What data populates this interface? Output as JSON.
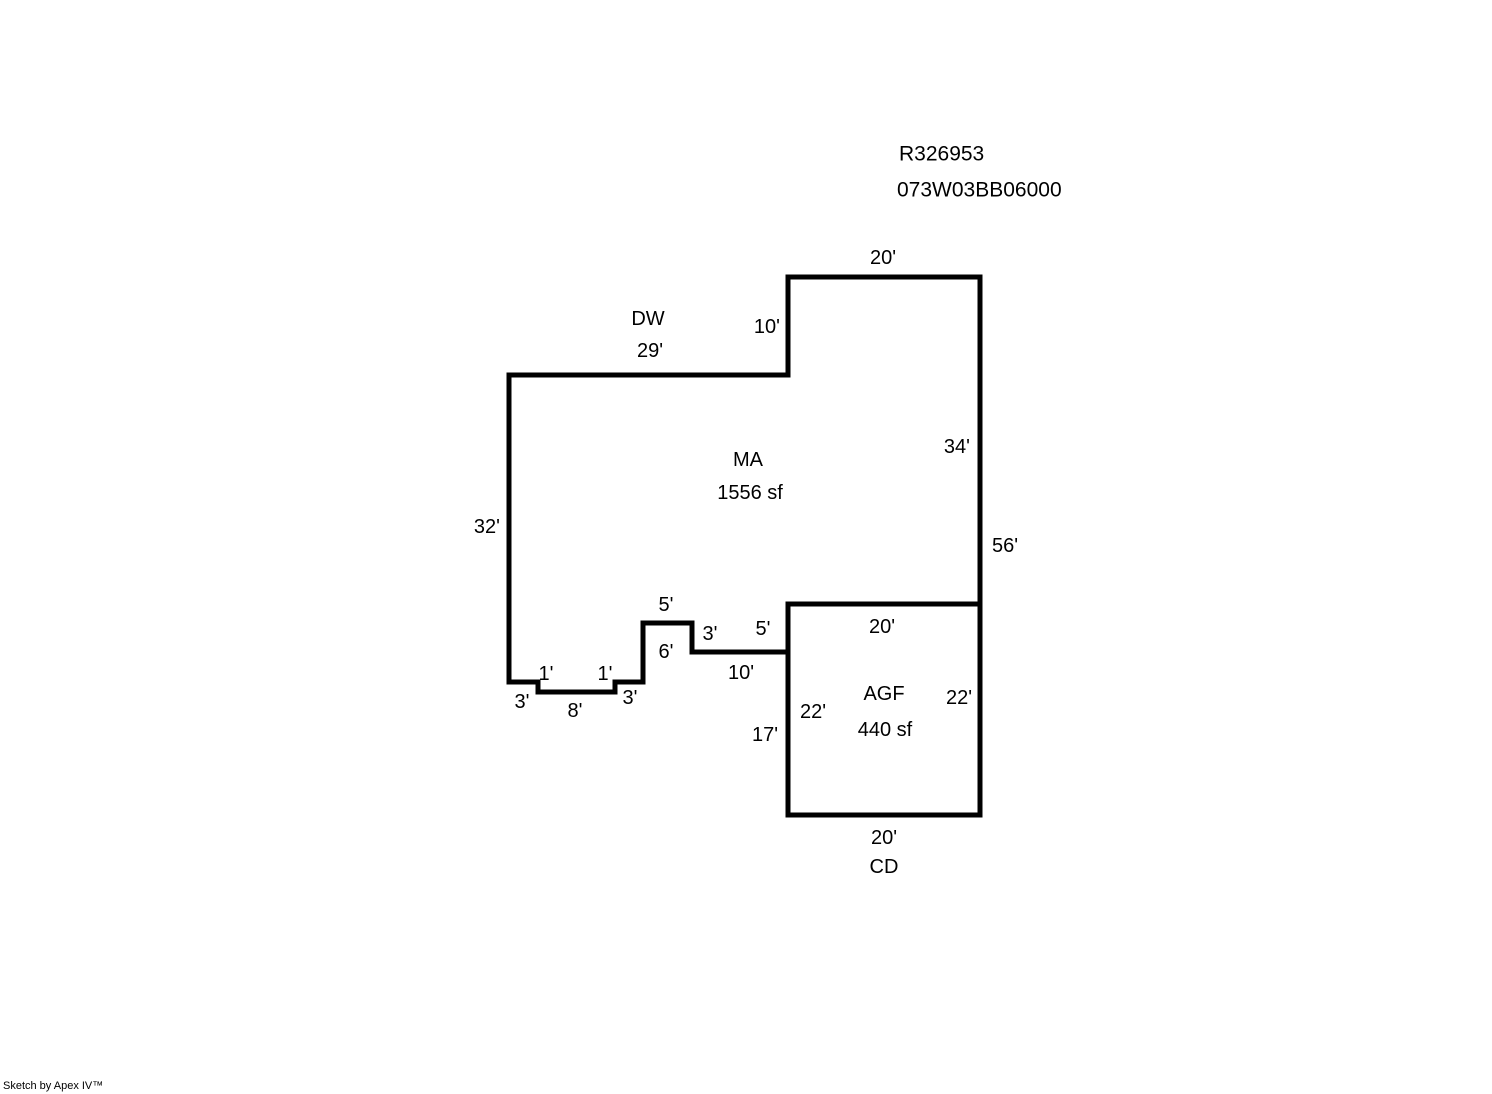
{
  "page": {
    "background_color": "#ffffff",
    "line_color": "#000000"
  },
  "header": {
    "parcel_id": "R326953",
    "account_number": "073W03BB06000"
  },
  "footer": {
    "credit": "Sketch by Apex IV™"
  },
  "sketch": {
    "areas": [
      {
        "code": "MA",
        "size": "1556 sf"
      },
      {
        "code": "AGF",
        "size": "440 sf"
      },
      {
        "code": "DW"
      },
      {
        "code": "CD"
      }
    ],
    "labels": [
      {
        "name": "dim-ma-top-20",
        "text": "20'",
        "x": 883,
        "y": 258,
        "anchor": "middle"
      },
      {
        "name": "dim-ma-10",
        "text": "10'",
        "x": 780,
        "y": 327,
        "anchor": "end"
      },
      {
        "name": "area-dw-code",
        "text": "DW",
        "x": 648,
        "y": 319,
        "anchor": "middle"
      },
      {
        "name": "dim-dw-29",
        "text": "29'",
        "x": 650,
        "y": 351,
        "anchor": "middle"
      },
      {
        "name": "area-ma-code",
        "text": "MA",
        "x": 748,
        "y": 460,
        "anchor": "middle"
      },
      {
        "name": "area-ma-size",
        "text": "1556 sf",
        "x": 750,
        "y": 493,
        "anchor": "middle"
      },
      {
        "name": "dim-ma-34",
        "text": "34'",
        "x": 970,
        "y": 447,
        "anchor": "end"
      },
      {
        "name": "dim-right-56",
        "text": "56'",
        "x": 992,
        "y": 546,
        "anchor": "start"
      },
      {
        "name": "dim-ma-left-32",
        "text": "32'",
        "x": 500,
        "y": 527,
        "anchor": "end"
      },
      {
        "name": "dim-jog-5-top",
        "text": "5'",
        "x": 666,
        "y": 605,
        "anchor": "middle"
      },
      {
        "name": "dim-jog-3-step",
        "text": "3'",
        "x": 710,
        "y": 634,
        "anchor": "middle"
      },
      {
        "name": "dim-agf-left-5",
        "text": "5'",
        "x": 763,
        "y": 629,
        "anchor": "middle"
      },
      {
        "name": "dim-jog-6",
        "text": "6'",
        "x": 666,
        "y": 652,
        "anchor": "middle"
      },
      {
        "name": "dim-jog-10",
        "text": "10'",
        "x": 741,
        "y": 673,
        "anchor": "middle"
      },
      {
        "name": "dim-step-1-left",
        "text": "1'",
        "x": 546,
        "y": 674,
        "anchor": "middle"
      },
      {
        "name": "dim-step-1-right",
        "text": "1'",
        "x": 605,
        "y": 674,
        "anchor": "middle"
      },
      {
        "name": "dim-step-3-left",
        "text": "3'",
        "x": 522,
        "y": 702,
        "anchor": "middle"
      },
      {
        "name": "dim-step-8",
        "text": "8'",
        "x": 575,
        "y": 711,
        "anchor": "middle"
      },
      {
        "name": "dim-step-3-right",
        "text": "3'",
        "x": 630,
        "y": 698,
        "anchor": "middle"
      },
      {
        "name": "dim-agf-top-20",
        "text": "20'",
        "x": 882,
        "y": 627,
        "anchor": "middle"
      },
      {
        "name": "area-agf-code",
        "text": "AGF",
        "x": 884,
        "y": 694,
        "anchor": "middle"
      },
      {
        "name": "area-agf-size",
        "text": "440 sf",
        "x": 885,
        "y": 730,
        "anchor": "middle"
      },
      {
        "name": "dim-agf-22-left",
        "text": "22'",
        "x": 813,
        "y": 712,
        "anchor": "middle"
      },
      {
        "name": "dim-agf-22-right",
        "text": "22'",
        "x": 959,
        "y": 698,
        "anchor": "middle"
      },
      {
        "name": "dim-agf-left-17",
        "text": "17'",
        "x": 765,
        "y": 735,
        "anchor": "middle"
      },
      {
        "name": "dim-agf-bottom-20",
        "text": "20'",
        "x": 884,
        "y": 838,
        "anchor": "middle"
      },
      {
        "name": "area-cd-code",
        "text": "CD",
        "x": 884,
        "y": 867,
        "anchor": "middle"
      }
    ]
  }
}
